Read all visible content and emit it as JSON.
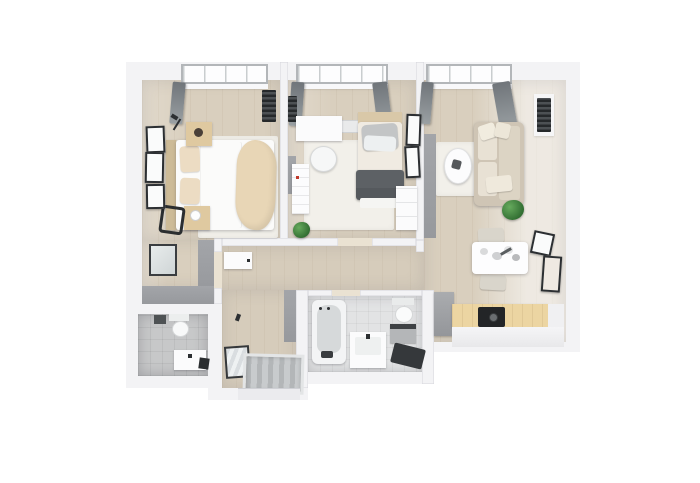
{
  "scene": {
    "type": "3d-floorplan-render",
    "view": "top-down",
    "description": "Rendered top-down 3D floor plan of a two-bedroom apartment on a white background"
  },
  "colors": {
    "bg": "#ffffff",
    "wall": "#f3f3f5",
    "wall-face": "#97999d",
    "wood": "#d9cfbe",
    "wood-hall": "#d6ccbb",
    "rug": "#f2f0ea",
    "duvet": "#fbfbfa",
    "blanket": "#e8d6b6",
    "pillow": "#ecdcc3",
    "wood-furniture": "#dfc9a0",
    "sofa": "#cfc5b5",
    "cushion": "#e8e1d4",
    "dark": "#2c2f32",
    "ottoman": "#5d6165",
    "curtain": "#82878a",
    "tile": "#c7c8c9",
    "tile-light": "#e2e3e4",
    "white-furniture": "#fbfbfc",
    "counter": "#ecd5a2",
    "cooktop": "#232527",
    "plant": "#2f6b30",
    "window": "#fdfdfe",
    "frame-gray": "#b3b6b9"
  },
  "rooms": {
    "bedroom": {
      "label": "Bedroom"
    },
    "bedroom_alcove": {
      "label": "Bedroom alcove"
    },
    "office": {
      "label": "Office"
    },
    "living": {
      "label": "Living Room"
    },
    "kitchen": {
      "label": "Kitchen"
    },
    "hallway": {
      "label": "Hallway"
    },
    "entry": {
      "label": "Entry Hall"
    },
    "bathroom": {
      "label": "Bathroom"
    },
    "wc": {
      "label": "WC"
    }
  },
  "labels": {
    "bed": "Double bed",
    "headboard": "Headboard",
    "duvet": "Duvet",
    "blanket": "Throw blanket",
    "pillow": "Pillow",
    "nightstand": "Nightstand",
    "lamp": "Lamp",
    "chair": "Chair",
    "wardrobe": "Wardrobe",
    "mirror": "Mirror",
    "desk": "Desk",
    "desk_chair": "Desk chair",
    "daybed": "Daybed",
    "ottoman": "Ottoman",
    "bookshelf": "Bookshelf",
    "dresser": "Dresser",
    "sofa": "Corner sofa",
    "coffee_table": "Coffee table",
    "dining_table": "Dining table",
    "dining_chair": "Dining chair",
    "counter": "Kitchen counter",
    "cooktop": "Cooktop",
    "cabinet": "Cabinet",
    "bathtub": "Bathtub",
    "sink": "Sink vanity",
    "toilet": "Toilet",
    "washer": "Washing machine",
    "bath_mat": "Bath mat",
    "door_mat": "Door mat",
    "front_door": "Front door",
    "plant": "Plant",
    "window": "Window",
    "curtain": "Curtain",
    "radiator": "Radiator",
    "rug": "Rug",
    "frame": "Wall art",
    "entry_cabinet": "Wall cabinet",
    "threshold": "Door opening"
  }
}
